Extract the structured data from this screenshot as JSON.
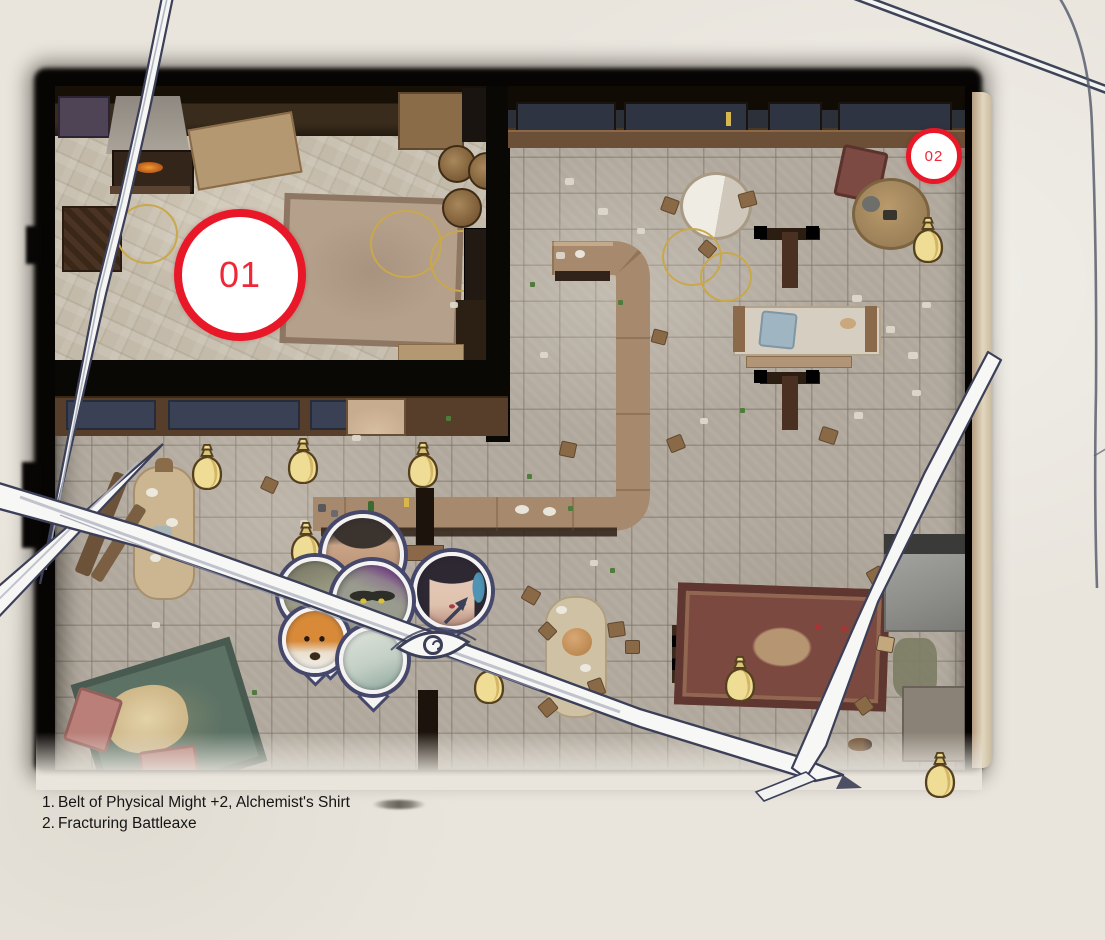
{
  "colors": {
    "parchment": "#e9e5dd",
    "marker_red": "#e81828",
    "marker_text": "#ef2837",
    "ink_navy": "#3c3f58",
    "stroke_white": "#f7f7f6",
    "bag_gold": "#efdd96",
    "bag_shadow": "#c9a753",
    "bag_outline": "#55411e",
    "legend_ink": "#151515"
  },
  "icons": {
    "money_bag": "sack-of-gold",
    "party_token": "round-portrait-token",
    "loot_marker": "red-numbered-circle",
    "map_eye": "hand-drawn-eye-with-arrow"
  },
  "legend": {
    "items": [
      {
        "number": "1.",
        "label": "Belt of Physical Might +2, Alchemist's Shirt"
      },
      {
        "number": "2.",
        "label": "Fracturing Battleaxe"
      }
    ]
  },
  "markers": [
    {
      "label": "01",
      "x": 240,
      "y": 275,
      "r": 66,
      "border": 8,
      "font": 36
    },
    {
      "label": "02",
      "x": 934,
      "y": 156,
      "r": 28,
      "border": 5,
      "font": 15
    }
  ],
  "loot_bags": [
    {
      "x": 207,
      "y": 468
    },
    {
      "x": 303,
      "y": 462
    },
    {
      "x": 423,
      "y": 466
    },
    {
      "x": 306,
      "y": 546
    },
    {
      "x": 928,
      "y": 241
    },
    {
      "x": 489,
      "y": 682
    },
    {
      "x": 740,
      "y": 680
    },
    {
      "x": 940,
      "y": 776
    }
  ],
  "party_tokens": [
    {
      "name": "male-human-portrait",
      "x": 363,
      "y": 555,
      "r": 41,
      "art": "man"
    },
    {
      "name": "hooded-companion-portrait",
      "x": 315,
      "y": 593,
      "r": 36,
      "art": "hidden"
    },
    {
      "name": "female-human-portrait",
      "x": 452,
      "y": 591,
      "r": 39,
      "art": "woman"
    },
    {
      "name": "half-orc-portrait",
      "x": 372,
      "y": 601,
      "r": 40,
      "art": "orc"
    },
    {
      "name": "fox-portrait",
      "x": 315,
      "y": 640,
      "r": 33,
      "art": "fox"
    },
    {
      "name": "pale-creature-portrait",
      "x": 373,
      "y": 660,
      "r": 34,
      "art": "pale"
    }
  ],
  "pointers": [
    {
      "x": 315,
      "y": 670
    },
    {
      "x": 373,
      "y": 696
    },
    {
      "x": 450,
      "y": 628
    },
    {
      "x": 330,
      "y": 664
    }
  ]
}
